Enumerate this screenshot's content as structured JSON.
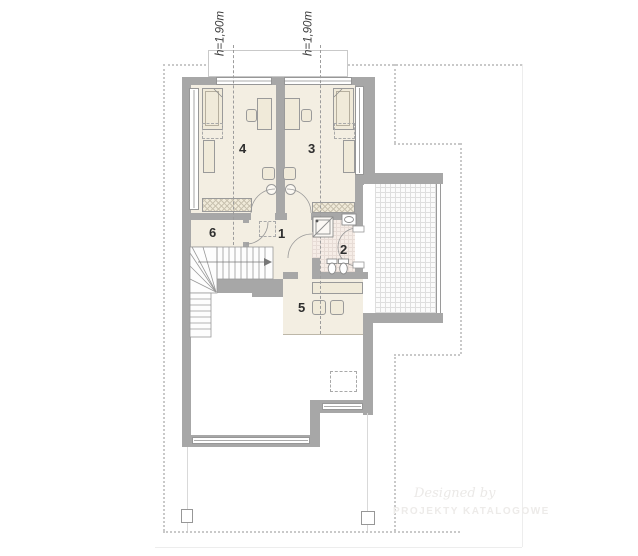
{
  "plan": {
    "height_labels": [
      "h=1,90m",
      "h=1,90m"
    ],
    "rooms": [
      {
        "number": "1"
      },
      {
        "number": "2"
      },
      {
        "number": "3"
      },
      {
        "number": "4"
      },
      {
        "number": "5"
      },
      {
        "number": "6"
      }
    ],
    "watermark": {
      "line1": "Designed by",
      "line2": "PROJEKTY KATALOGOWE"
    },
    "colors": {
      "wall": "#a7a7a7",
      "floor": "#f3eee2",
      "bath_floor": "#f6ede7",
      "balcony_tile": "#fbfbfb",
      "stroke": "#999999",
      "roof_outline": "#c9c9c9"
    }
  }
}
